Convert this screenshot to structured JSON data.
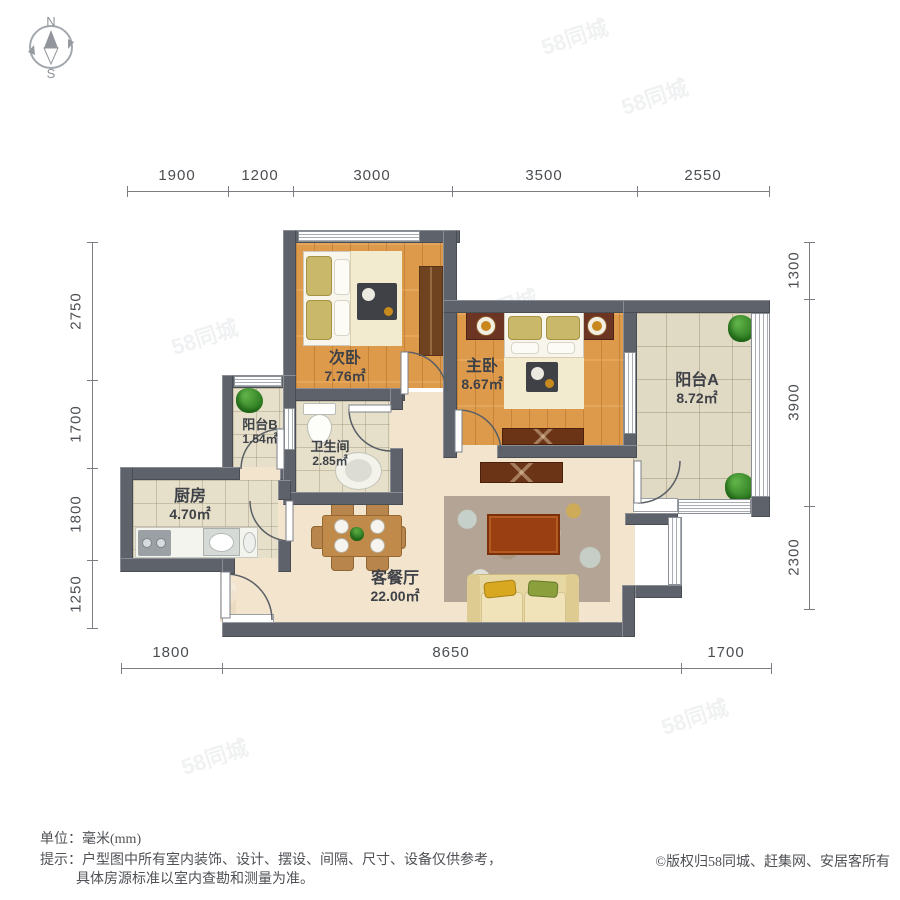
{
  "compass": {
    "north": "N",
    "south": "S"
  },
  "dimensions": {
    "unit": "mm",
    "top": [
      "1900",
      "1200",
      "3000",
      "3500",
      "2550"
    ],
    "left": [
      "2750",
      "1700",
      "1800",
      "1250"
    ],
    "right": [
      "1300",
      "3900",
      "2300"
    ],
    "bottom": [
      "1800",
      "8650",
      "1700"
    ]
  },
  "rooms": {
    "secondary_bedroom": {
      "name": "次卧",
      "area": "7.76㎡"
    },
    "master_bedroom": {
      "name": "主卧",
      "area": "8.67㎡"
    },
    "balcony_a": {
      "name": "阳台A",
      "area": "8.72㎡"
    },
    "balcony_b": {
      "name": "阳台B",
      "area": "1.54㎡"
    },
    "bathroom": {
      "name": "卫生间",
      "area": "2.85㎡"
    },
    "kitchen": {
      "name": "厨房",
      "area": "4.70㎡"
    },
    "living_dining": {
      "name": "客餐厅",
      "area": "22.00㎡"
    }
  },
  "footer": {
    "unit_label": "单位：",
    "unit_value": "毫米(mm)",
    "tip_label": "提示：",
    "tip_line1": "户型图中所有室内装饰、设计、摆设、间隔、尺寸、设备仅供参考，",
    "tip_line2": "具体房源标准以室内查勘和测量为准。",
    "copyright": "©版权归58同城、赶集网、安居客所有"
  },
  "watermark": "58同城",
  "colors": {
    "wall": "#5d626b",
    "wood_floor": "#dd9a4b",
    "tile_floor": "#e0d9c4",
    "living_floor": "#f2e4cd",
    "plant": "#2f7d22",
    "accent_wood": "#6b3416"
  }
}
